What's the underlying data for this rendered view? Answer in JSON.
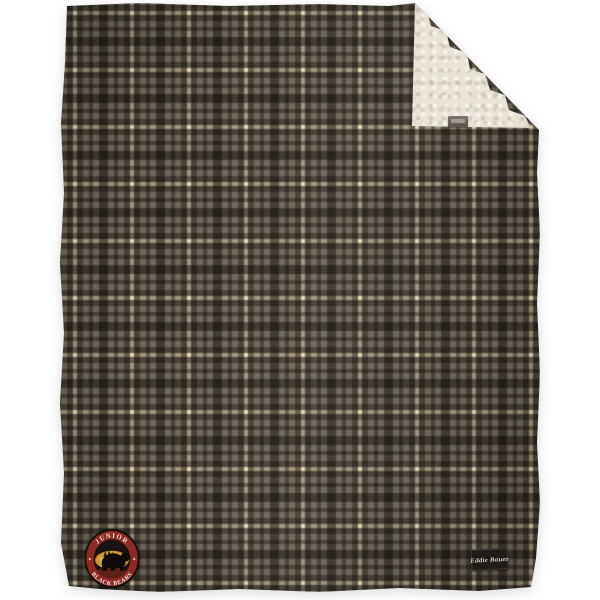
{
  "canvas": {
    "background": "#ffffff"
  },
  "blanket": {
    "description": "gray plaid fleece blanket with sherpa-lined back, top-right corner folded over",
    "plaid_colors": {
      "base_gray": "#716b62",
      "dark_band": "#2f2b24",
      "cream_stripe": "#e3d9ba"
    },
    "sherpa_color": "#e9e4d6"
  },
  "patch": {
    "top_text": "JUNIOR",
    "bottom_text": "BLACK BEARS",
    "emblem": "black-bear",
    "ring_color": "#8d2a26",
    "gold_color": "#d8a93f",
    "center_color": "#181310",
    "text_color": "#efe9da"
  },
  "brand_tag": {
    "label": "Eddie Bauer",
    "background": "#1f1d1a",
    "text_color": "#d8d2c0"
  }
}
